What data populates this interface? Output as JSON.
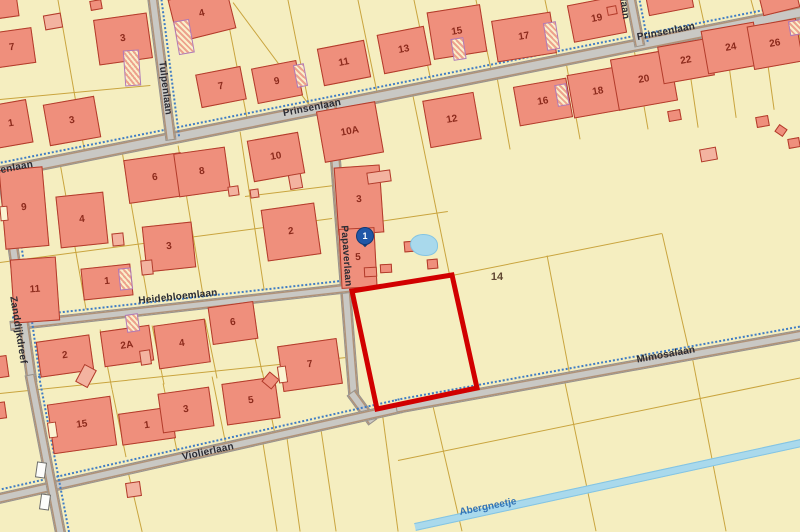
{
  "map": {
    "width": 800,
    "height": 532,
    "colors": {
      "background": "#f5eec0",
      "house_fill": "#ef8f7c",
      "house_border": "#b23b2a",
      "house_number": "#8c2a1c",
      "road_fill": "#c9c8c4",
      "boundary_line": "#c9a43e",
      "cycle_path": "#3f7cc4",
      "water_fill": "#a9d9ec",
      "water_text": "#3273b5",
      "highlight_outline": "#d10000",
      "marker_blue": "#2057a7",
      "street_text": "#2b2b33"
    },
    "roads": [
      {
        "name": "Prinsenlaan",
        "x1": -15,
        "y1": 175,
        "x2": 815,
        "y2": 9,
        "w": 13,
        "cycle": true
      },
      {
        "name": "Tulpenlaan",
        "x1": 152,
        "y1": -8,
        "x2": 171,
        "y2": 140,
        "w": 11,
        "cycle": true
      },
      {
        "name": "Prinsenlaan",
        "x1": 629,
        "y1": -10,
        "x2": 640,
        "y2": 46,
        "w": 11,
        "cycle": true
      },
      {
        "name": "Papaverlaan",
        "x1": 331,
        "y1": 102,
        "x2": 354,
        "y2": 398,
        "w": 11,
        "cycle": false
      },
      {
        "name": "Papaverlaan",
        "x1": 351,
        "y1": 392,
        "x2": 373,
        "y2": 422,
        "w": 11,
        "cycle": false
      },
      {
        "name": "Heidebloemlaan",
        "x1": 10,
        "y1": 326,
        "x2": 350,
        "y2": 288,
        "w": 10,
        "cycle": true
      },
      {
        "name": "Violierlaan",
        "x1": -10,
        "y1": 500,
        "x2": 402,
        "y2": 407,
        "w": 11,
        "cycle": true
      },
      {
        "name": "Mimosalaan",
        "x1": 396,
        "y1": 408,
        "x2": 815,
        "y2": 332,
        "w": 11,
        "cycle": true
      },
      {
        "name": "Zanddijkdreef",
        "x1": 4,
        "y1": 182,
        "x2": 32,
        "y2": 382,
        "w": 11,
        "cycle": true
      },
      {
        "name": "Zanddijkdreef",
        "x1": 30,
        "y1": 374,
        "x2": 62,
        "y2": 540,
        "w": 11,
        "cycle": true
      }
    ],
    "road_labels": [
      {
        "text": "Prinsenlaan",
        "x": 312,
        "y": 108,
        "angle": -11
      },
      {
        "text": "Prinsenlaan",
        "x": 666,
        "y": 32,
        "angle": -11
      },
      {
        "text": "Prinsenlaan",
        "x": 4,
        "y": 170,
        "angle": -11
      },
      {
        "text": "Prinsenlaan",
        "x": 622,
        "y": -10,
        "angle": 83
      },
      {
        "text": "Tulpenlaan",
        "x": 165,
        "y": 88,
        "angle": 83
      },
      {
        "text": "Papaverlaan",
        "x": 346,
        "y": 256,
        "angle": 86
      },
      {
        "text": "Heidebloemlaan",
        "x": 178,
        "y": 297,
        "angle": -6
      },
      {
        "text": "Violierlaan",
        "x": 208,
        "y": 452,
        "angle": -12
      },
      {
        "text": "Mimosalaan",
        "x": 666,
        "y": 355,
        "angle": -10
      },
      {
        "text": "Zanddijkdreef",
        "x": 18,
        "y": 330,
        "angle": 81
      }
    ],
    "water": {
      "name": "Abergneetje",
      "x1": 415,
      "y1": 527,
      "x2": 815,
      "y2": 440,
      "w": 8,
      "label": {
        "text": "Abergneetje",
        "x": 488,
        "y": 507,
        "angle": -11
      }
    },
    "parcel_labels": [
      {
        "text": "14",
        "x": 497,
        "y": 277
      }
    ],
    "highlight_parcel": {
      "color": "#d10000",
      "stroke_width": 5,
      "points": [
        [
          352,
          291
        ],
        [
          452,
          275
        ],
        [
          477,
          388
        ],
        [
          377,
          409
        ]
      ]
    },
    "marker": {
      "label": "1",
      "x": 365,
      "y": 243
    },
    "pond": {
      "x": 410,
      "y": 234,
      "w": 28,
      "h": 22
    },
    "houses": [
      {
        "n": "7",
        "x": -10,
        "y": 30,
        "w": 44,
        "h": 36,
        "rot": -8
      },
      {
        "n": "",
        "x": -8,
        "y": -6,
        "w": 26,
        "h": 24,
        "rot": -8
      },
      {
        "n": "3",
        "x": 96,
        "y": 16,
        "w": 54,
        "h": 46,
        "rot": -8
      },
      {
        "n": "4",
        "x": 172,
        "y": -8,
        "w": 60,
        "h": 44,
        "rot": -14
      },
      {
        "n": "7",
        "x": 198,
        "y": 70,
        "w": 46,
        "h": 34,
        "rot": -11
      },
      {
        "n": "9",
        "x": 254,
        "y": 64,
        "w": 46,
        "h": 36,
        "rot": -11
      },
      {
        "n": "11",
        "x": 320,
        "y": 44,
        "w": 48,
        "h": 38,
        "rot": -11
      },
      {
        "n": "13",
        "x": 380,
        "y": 30,
        "w": 48,
        "h": 40,
        "rot": -11
      },
      {
        "n": "15",
        "x": 430,
        "y": 8,
        "w": 54,
        "h": 48,
        "rot": -9
      },
      {
        "n": "17",
        "x": 494,
        "y": 16,
        "w": 60,
        "h": 42,
        "rot": -9
      },
      {
        "n": "19",
        "x": 570,
        "y": 0,
        "w": 54,
        "h": 38,
        "rot": -11
      },
      {
        "n": "",
        "x": 646,
        "y": -16,
        "w": 46,
        "h": 28,
        "rot": -11
      },
      {
        "n": "",
        "x": 760,
        "y": -12,
        "w": 38,
        "h": 24,
        "rot": -14
      },
      {
        "n": "10A",
        "x": 320,
        "y": 106,
        "w": 60,
        "h": 52,
        "rot": -10
      },
      {
        "n": "12",
        "x": 426,
        "y": 96,
        "w": 52,
        "h": 48,
        "rot": -10
      },
      {
        "n": "16",
        "x": 516,
        "y": 82,
        "w": 54,
        "h": 40,
        "rot": -10
      },
      {
        "n": "18",
        "x": 570,
        "y": 70,
        "w": 56,
        "h": 44,
        "rot": -10
      },
      {
        "n": "20",
        "x": 614,
        "y": 54,
        "w": 60,
        "h": 52,
        "rot": -10
      },
      {
        "n": "22",
        "x": 660,
        "y": 42,
        "w": 52,
        "h": 38,
        "rot": -10
      },
      {
        "n": "24",
        "x": 704,
        "y": 26,
        "w": 54,
        "h": 44,
        "rot": -10
      },
      {
        "n": "26",
        "x": 750,
        "y": 22,
        "w": 50,
        "h": 44,
        "rot": -10
      },
      {
        "n": "1",
        "x": -8,
        "y": 102,
        "w": 38,
        "h": 44,
        "rot": -10
      },
      {
        "n": "3",
        "x": 46,
        "y": 100,
        "w": 52,
        "h": 42,
        "rot": -10
      },
      {
        "n": "9",
        "x": 2,
        "y": 168,
        "w": 44,
        "h": 80,
        "rot": -5
      },
      {
        "n": "4",
        "x": 58,
        "y": 194,
        "w": 48,
        "h": 52,
        "rot": -6
      },
      {
        "n": "6",
        "x": 126,
        "y": 156,
        "w": 58,
        "h": 44,
        "rot": -8
      },
      {
        "n": "8",
        "x": 176,
        "y": 150,
        "w": 52,
        "h": 44,
        "rot": -8
      },
      {
        "n": "3",
        "x": 144,
        "y": 224,
        "w": 50,
        "h": 46,
        "rot": -6
      },
      {
        "n": "1",
        "x": 82,
        "y": 266,
        "w": 50,
        "h": 32,
        "rot": -6
      },
      {
        "n": "11",
        "x": 12,
        "y": 258,
        "w": 46,
        "h": 64,
        "rot": -4
      },
      {
        "n": "10",
        "x": 250,
        "y": 136,
        "w": 52,
        "h": 42,
        "rot": -10
      },
      {
        "n": "2",
        "x": 264,
        "y": 206,
        "w": 54,
        "h": 52,
        "rot": -8
      },
      {
        "n": "3",
        "x": 336,
        "y": 166,
        "w": 46,
        "h": 68,
        "rot": -4
      },
      {
        "n": "5",
        "x": 340,
        "y": 228,
        "w": 36,
        "h": 60,
        "rot": -3
      },
      {
        "n": "2",
        "x": 38,
        "y": 338,
        "w": 54,
        "h": 36,
        "rot": -8
      },
      {
        "n": "2A",
        "x": 102,
        "y": 328,
        "w": 50,
        "h": 36,
        "rot": -8
      },
      {
        "n": "4",
        "x": 156,
        "y": 322,
        "w": 52,
        "h": 44,
        "rot": -8
      },
      {
        "n": "6",
        "x": 210,
        "y": 304,
        "w": 46,
        "h": 38,
        "rot": -8
      },
      {
        "n": "7",
        "x": 280,
        "y": 342,
        "w": 60,
        "h": 46,
        "rot": -8
      },
      {
        "n": "15",
        "x": 50,
        "y": 400,
        "w": 64,
        "h": 50,
        "rot": -8
      },
      {
        "n": "1",
        "x": 120,
        "y": 410,
        "w": 54,
        "h": 32,
        "rot": -8
      },
      {
        "n": "3",
        "x": 160,
        "y": 390,
        "w": 52,
        "h": 40,
        "rot": -8
      },
      {
        "n": "5",
        "x": 224,
        "y": 380,
        "w": 54,
        "h": 42,
        "rot": -8
      },
      {
        "n": "",
        "x": -8,
        "y": 356,
        "w": 16,
        "h": 22,
        "rot": -8
      }
    ],
    "sheds": [
      {
        "x": 44,
        "y": 14,
        "w": 18,
        "h": 15,
        "rot": -10,
        "k": "l"
      },
      {
        "x": 90,
        "y": 0,
        "w": 12,
        "h": 10,
        "rot": -10,
        "k": "s"
      },
      {
        "x": 607,
        "y": 6,
        "w": 10,
        "h": 9,
        "rot": -11,
        "k": "s"
      },
      {
        "x": 668,
        "y": 110,
        "w": 13,
        "h": 11,
        "rot": -10,
        "k": "s"
      },
      {
        "x": 700,
        "y": 148,
        "w": 17,
        "h": 13,
        "rot": -10,
        "k": "l"
      },
      {
        "x": 756,
        "y": 116,
        "w": 13,
        "h": 11,
        "rot": -10,
        "k": "s"
      },
      {
        "x": 788,
        "y": 138,
        "w": 12,
        "h": 10,
        "rot": -10,
        "k": "s"
      },
      {
        "x": 776,
        "y": 126,
        "w": 10,
        "h": 9,
        "rot": 35,
        "k": "s"
      },
      {
        "x": 228,
        "y": 186,
        "w": 11,
        "h": 10,
        "rot": -8,
        "k": "l"
      },
      {
        "x": 250,
        "y": 189,
        "w": 9,
        "h": 9,
        "rot": -8,
        "k": "l"
      },
      {
        "x": 141,
        "y": 260,
        "w": 12,
        "h": 15,
        "rot": -6,
        "k": "l"
      },
      {
        "x": 112,
        "y": 233,
        "w": 12,
        "h": 13,
        "rot": -6,
        "k": "l"
      },
      {
        "x": 289,
        "y": 174,
        "w": 13,
        "h": 15,
        "rot": -10,
        "k": "l"
      },
      {
        "x": 367,
        "y": 171,
        "w": 24,
        "h": 12,
        "rot": -8,
        "k": "l"
      },
      {
        "x": 364,
        "y": 267,
        "w": 13,
        "h": 10,
        "rot": -3,
        "k": "s"
      },
      {
        "x": 380,
        "y": 264,
        "w": 12,
        "h": 9,
        "rot": -3,
        "k": "s"
      },
      {
        "x": 404,
        "y": 241,
        "w": 12,
        "h": 11,
        "rot": -5,
        "k": "s"
      },
      {
        "x": 427,
        "y": 259,
        "w": 11,
        "h": 10,
        "rot": -5,
        "k": "s"
      },
      {
        "x": 79,
        "y": 366,
        "w": 14,
        "h": 20,
        "rot": 28,
        "k": "l"
      },
      {
        "x": 140,
        "y": 350,
        "w": 11,
        "h": 15,
        "rot": -8,
        "k": "l"
      },
      {
        "x": 264,
        "y": 374,
        "w": 13,
        "h": 13,
        "rot": 40,
        "k": "s"
      },
      {
        "x": 126,
        "y": 482,
        "w": 15,
        "h": 15,
        "rot": -8,
        "k": "l"
      },
      {
        "x": -5,
        "y": 402,
        "w": 11,
        "h": 17,
        "rot": -8,
        "k": "s"
      },
      {
        "x": 278,
        "y": 366,
        "w": 9,
        "h": 17,
        "rot": -8,
        "k": "w"
      },
      {
        "x": 48,
        "y": 422,
        "w": 9,
        "h": 16,
        "rot": -8,
        "k": "w"
      },
      {
        "x": 0,
        "y": 206,
        "w": 8,
        "h": 15,
        "rot": -5,
        "k": "w"
      }
    ],
    "annexes": [
      {
        "x": 124,
        "y": 50,
        "w": 16,
        "h": 36,
        "rot": -4
      },
      {
        "x": 176,
        "y": 20,
        "w": 16,
        "h": 34,
        "rot": -10
      },
      {
        "x": 295,
        "y": 64,
        "w": 11,
        "h": 23,
        "rot": -11
      },
      {
        "x": 452,
        "y": 38,
        "w": 13,
        "h": 22,
        "rot": -9
      },
      {
        "x": 545,
        "y": 22,
        "w": 13,
        "h": 28,
        "rot": -9
      },
      {
        "x": 556,
        "y": 84,
        "w": 12,
        "h": 22,
        "rot": -10
      },
      {
        "x": 119,
        "y": 268,
        "w": 13,
        "h": 22,
        "rot": -6
      },
      {
        "x": 126,
        "y": 314,
        "w": 13,
        "h": 18,
        "rot": -8
      },
      {
        "x": 789,
        "y": 20,
        "w": 15,
        "h": 15,
        "rot": -10
      }
    ],
    "lines": [
      {
        "x1": 85,
        "y1": 154,
        "x2": 58,
        "y2": 0
      },
      {
        "x1": 248,
        "y1": 123,
        "x2": 224,
        "y2": 0
      },
      {
        "x1": 310,
        "y1": 110,
        "x2": 288,
        "y2": 0
      },
      {
        "x1": 378,
        "y1": 97,
        "x2": 358,
        "y2": 0
      },
      {
        "x1": 432,
        "y1": 86,
        "x2": 414,
        "y2": 0
      },
      {
        "x1": 492,
        "y1": 74,
        "x2": 476,
        "y2": 0
      },
      {
        "x1": 558,
        "y1": 61,
        "x2": 545,
        "y2": 0
      },
      {
        "x1": 706,
        "y1": 32,
        "x2": 699,
        "y2": 0
      },
      {
        "x1": 757,
        "y1": 22,
        "x2": 751,
        "y2": 0
      },
      {
        "x1": 0,
        "y1": 100,
        "x2": 150,
        "y2": 86
      },
      {
        "x1": 233,
        "y1": 3,
        "x2": 308,
        "y2": 104
      },
      {
        "x1": 0,
        "y1": 263,
        "x2": 332,
        "y2": 219
      },
      {
        "x1": 60,
        "y1": 164,
        "x2": 86,
        "y2": 310
      },
      {
        "x1": 122,
        "y1": 152,
        "x2": 148,
        "y2": 302
      },
      {
        "x1": 178,
        "y1": 146,
        "x2": 203,
        "y2": 296
      },
      {
        "x1": 240,
        "y1": 132,
        "x2": 264,
        "y2": 290
      },
      {
        "x1": 245,
        "y1": 197,
        "x2": 334,
        "y2": 186
      },
      {
        "x1": 412,
        "y1": 92,
        "x2": 450,
        "y2": 278
      },
      {
        "x1": 452,
        "y1": 276,
        "x2": 662,
        "y2": 234
      },
      {
        "x1": 547,
        "y1": 256,
        "x2": 570,
        "y2": 377
      },
      {
        "x1": 497,
        "y1": 78,
        "x2": 510,
        "y2": 150
      },
      {
        "x1": 566,
        "y1": 63,
        "x2": 580,
        "y2": 140
      },
      {
        "x1": 634,
        "y1": 50,
        "x2": 648,
        "y2": 130
      },
      {
        "x1": 685,
        "y1": 40,
        "x2": 698,
        "y2": 128
      },
      {
        "x1": 724,
        "y1": 30,
        "x2": 736,
        "y2": 118
      },
      {
        "x1": 762,
        "y1": 23,
        "x2": 774,
        "y2": 110
      },
      {
        "x1": 797,
        "y1": 16,
        "x2": 808,
        "y2": 104
      },
      {
        "x1": 662,
        "y1": 234,
        "x2": 690,
        "y2": 356
      },
      {
        "x1": 338,
        "y1": 228,
        "x2": 448,
        "y2": 212
      },
      {
        "x1": 0,
        "y1": 394,
        "x2": 356,
        "y2": 357
      },
      {
        "x1": 100,
        "y1": 330,
        "x2": 112,
        "y2": 390
      },
      {
        "x1": 152,
        "y1": 326,
        "x2": 164,
        "y2": 385
      },
      {
        "x1": 205,
        "y1": 320,
        "x2": 217,
        "y2": 379
      },
      {
        "x1": 250,
        "y1": 314,
        "x2": 262,
        "y2": 373
      },
      {
        "x1": 112,
        "y1": 390,
        "x2": 126,
        "y2": 458
      },
      {
        "x1": 163,
        "y1": 384,
        "x2": 177,
        "y2": 452
      },
      {
        "x1": 212,
        "y1": 377,
        "x2": 226,
        "y2": 446
      },
      {
        "x1": 262,
        "y1": 371,
        "x2": 276,
        "y2": 440
      },
      {
        "x1": 127,
        "y1": 468,
        "x2": 142,
        "y2": 532
      },
      {
        "x1": 262,
        "y1": 438,
        "x2": 277,
        "y2": 532
      },
      {
        "x1": 286,
        "y1": 432,
        "x2": 300,
        "y2": 532
      },
      {
        "x1": 320,
        "y1": 424,
        "x2": 336,
        "y2": 532
      },
      {
        "x1": 382,
        "y1": 412,
        "x2": 398,
        "y2": 532
      },
      {
        "x1": 433,
        "y1": 407,
        "x2": 462,
        "y2": 532
      },
      {
        "x1": 563,
        "y1": 374,
        "x2": 596,
        "y2": 532
      },
      {
        "x1": 692,
        "y1": 357,
        "x2": 726,
        "y2": 532
      },
      {
        "x1": 398,
        "y1": 461,
        "x2": 812,
        "y2": 376
      }
    ],
    "crossing_marks": [
      {
        "x": 36,
        "y": 462,
        "w": 10,
        "h": 16,
        "rot": 8
      },
      {
        "x": 40,
        "y": 494,
        "w": 10,
        "h": 16,
        "rot": 8
      }
    ]
  }
}
